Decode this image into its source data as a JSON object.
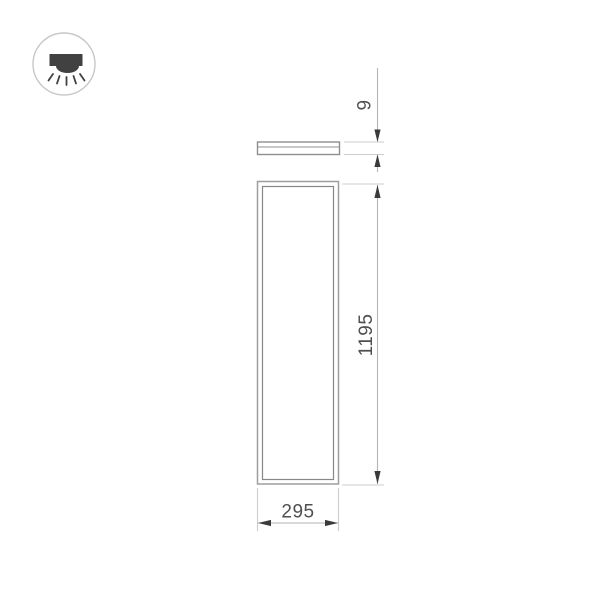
{
  "drawing": {
    "icon": {
      "name": "ceiling-mounted-light-icon",
      "fill": "#414141",
      "ring_color": "#c8c8c8"
    },
    "views": {
      "side": "panel-side-profile-view",
      "front": "panel-front-view"
    },
    "dimensions": {
      "thickness": "9",
      "height": "1195",
      "width": "295"
    },
    "colors": {
      "outline": "#9e9e9e",
      "inner_outline": "#878787",
      "extension_line": "#cdcdcd",
      "dimension_line": "#b3b3b3",
      "arrow": "#3a3a3a",
      "text": "#4f4f4f"
    }
  }
}
